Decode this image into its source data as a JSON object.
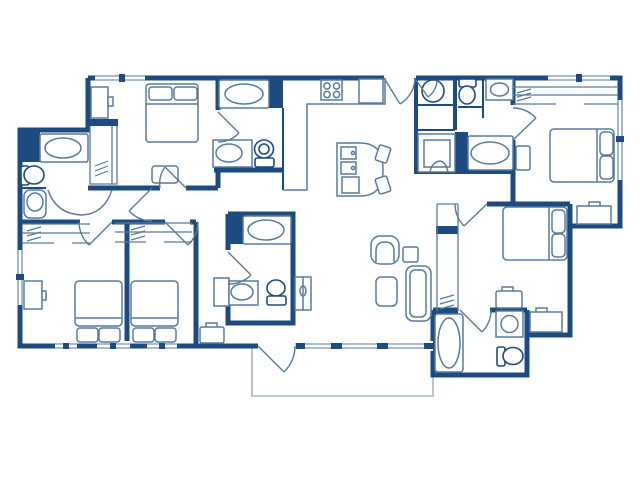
{
  "meta": {
    "type": "apartment-floor-plan",
    "style": "blueprint line drawing, navy on white",
    "visible_text": ""
  },
  "palette": {
    "wall_color": "#1d4b80",
    "fixture_color": "#587a9e",
    "patio_color": "#a6b7c9",
    "background": "#ffffff"
  },
  "rooms": [
    {
      "name": "bedroom-top-left",
      "furniture": [
        "double-bed",
        "dresser",
        "closet-with-rod",
        "nightstand"
      ]
    },
    {
      "name": "bathroom-top-center",
      "fixtures": [
        "bathtub",
        "vanity-sink",
        "toilet"
      ]
    },
    {
      "name": "kitchen",
      "fixtures": [
        "l-shaped-counter",
        "stove-4-burner",
        "refrigerator"
      ]
    },
    {
      "name": "dining-area",
      "furniture": [
        "dining-table",
        "chair",
        "chair"
      ]
    },
    {
      "name": "entry",
      "fixtures": [
        "entry-door-swing"
      ]
    },
    {
      "name": "powder-area",
      "fixtures": [
        "round-sink",
        "toilet",
        "vanity-sink"
      ]
    },
    {
      "name": "bathroom-top-right",
      "fixtures": [
        "shower-stall",
        "bathtub"
      ]
    },
    {
      "name": "bedroom-top-right",
      "furniture": [
        "double-bed",
        "closet-with-rod",
        "nightstand",
        "dresser"
      ]
    },
    {
      "name": "bedroom-mid-right",
      "furniture": [
        "double-bed",
        "tall-closet-with-rod",
        "nightstand",
        "dresser"
      ]
    },
    {
      "name": "bathroom-bottom-right",
      "fixtures": [
        "bathtub",
        "vanity-sink",
        "toilet"
      ]
    },
    {
      "name": "living-room",
      "furniture": [
        "sofa",
        "armchair",
        "side-table",
        "coffee-table"
      ]
    },
    {
      "name": "bathroom-left",
      "fixtures": [
        "bathtub",
        "toilet",
        "pedestal-sink"
      ]
    },
    {
      "name": "hallway",
      "fixtures": [
        "double-doors",
        "door"
      ]
    },
    {
      "name": "bedroom-bottom-left",
      "furniture": [
        "double-bed",
        "dresser",
        "closet-with-rod"
      ]
    },
    {
      "name": "bedroom-bottom-center",
      "furniture": [
        "double-bed",
        "closet-with-rod",
        "bench"
      ]
    },
    {
      "name": "vanity-alcove",
      "furniture": [
        "cabinet",
        "bench"
      ]
    },
    {
      "name": "bathroom-center",
      "fixtures": [
        "bathtub",
        "vanity-sink",
        "toilet",
        "utility-door"
      ]
    },
    {
      "name": "patio",
      "furniture": []
    }
  ],
  "counts": {
    "bedrooms": 5,
    "bathrooms": 4,
    "beds": 5,
    "bathtubs": 5,
    "showers": 1,
    "toilets": 5,
    "sinks": 7
  }
}
